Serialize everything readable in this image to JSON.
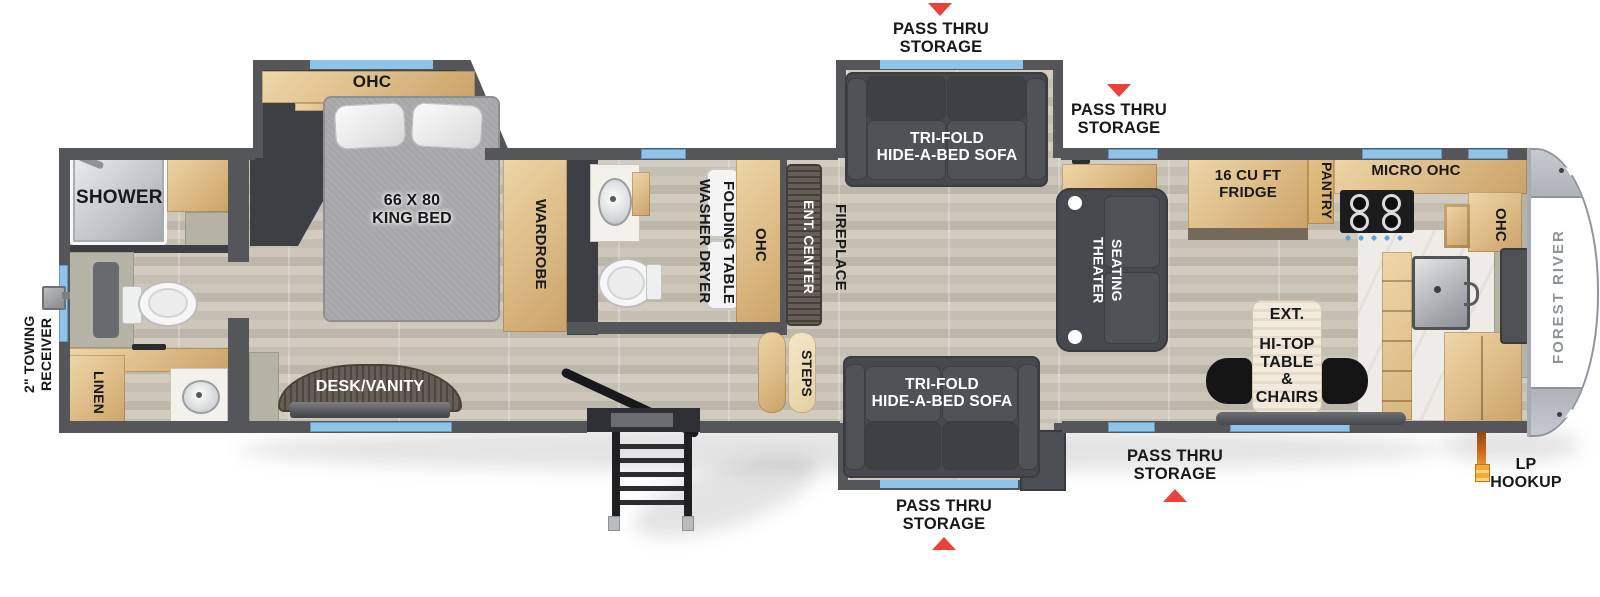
{
  "colors": {
    "wall": "#54565a",
    "window_blue": "#8ec4ea",
    "arrow_red": "#e8423a",
    "wood": "#e5c795",
    "charcoal": "#3d3f44",
    "sofa": "#47494e",
    "floor": "#cac4b8",
    "marble": "#f2f0ec",
    "sage": "#b4b3a6",
    "cap_white": "#ffffff",
    "brand_text": "#8e939c",
    "lp_orange": "#d2691e"
  },
  "exterior": {
    "pass_thru": "PASS THRU\nSTORAGE",
    "towing_line1": "2\" TOWING",
    "towing_line2": "RECEIVER",
    "lp_hookup": "LP\nHOOKUP",
    "brand": "FOREST RIVER"
  },
  "rear_bath": {
    "shower": "SHOWER",
    "linen": "LINEN"
  },
  "bedroom": {
    "ohc": "OHC",
    "king_bed": "66 X 80\nKING BED",
    "wardrobe": "WARDROBE",
    "desk_vanity": "DESK/VANITY"
  },
  "laundry": {
    "washer_dryer": "WASHER DRYER",
    "folding_table": "FOLDING TABLE",
    "ohc": "OHC"
  },
  "living": {
    "ent_center": "ENT. CENTER",
    "fireplace": "FIREPLACE",
    "steps": "STEPS",
    "sofa": "TRI-FOLD\nHIDE-A-BED SOFA",
    "theater_line1": "THEATER",
    "theater_line2": "SEATING"
  },
  "kitchen": {
    "fridge": "16 CU FT\nFRIDGE",
    "pantry": "PANTRY",
    "micro_ohc": "MICRO  OHC",
    "ohc": "OHC",
    "ext": "EXT.",
    "hitop": "HI-TOP\nTABLE &\nCHAIRS"
  }
}
